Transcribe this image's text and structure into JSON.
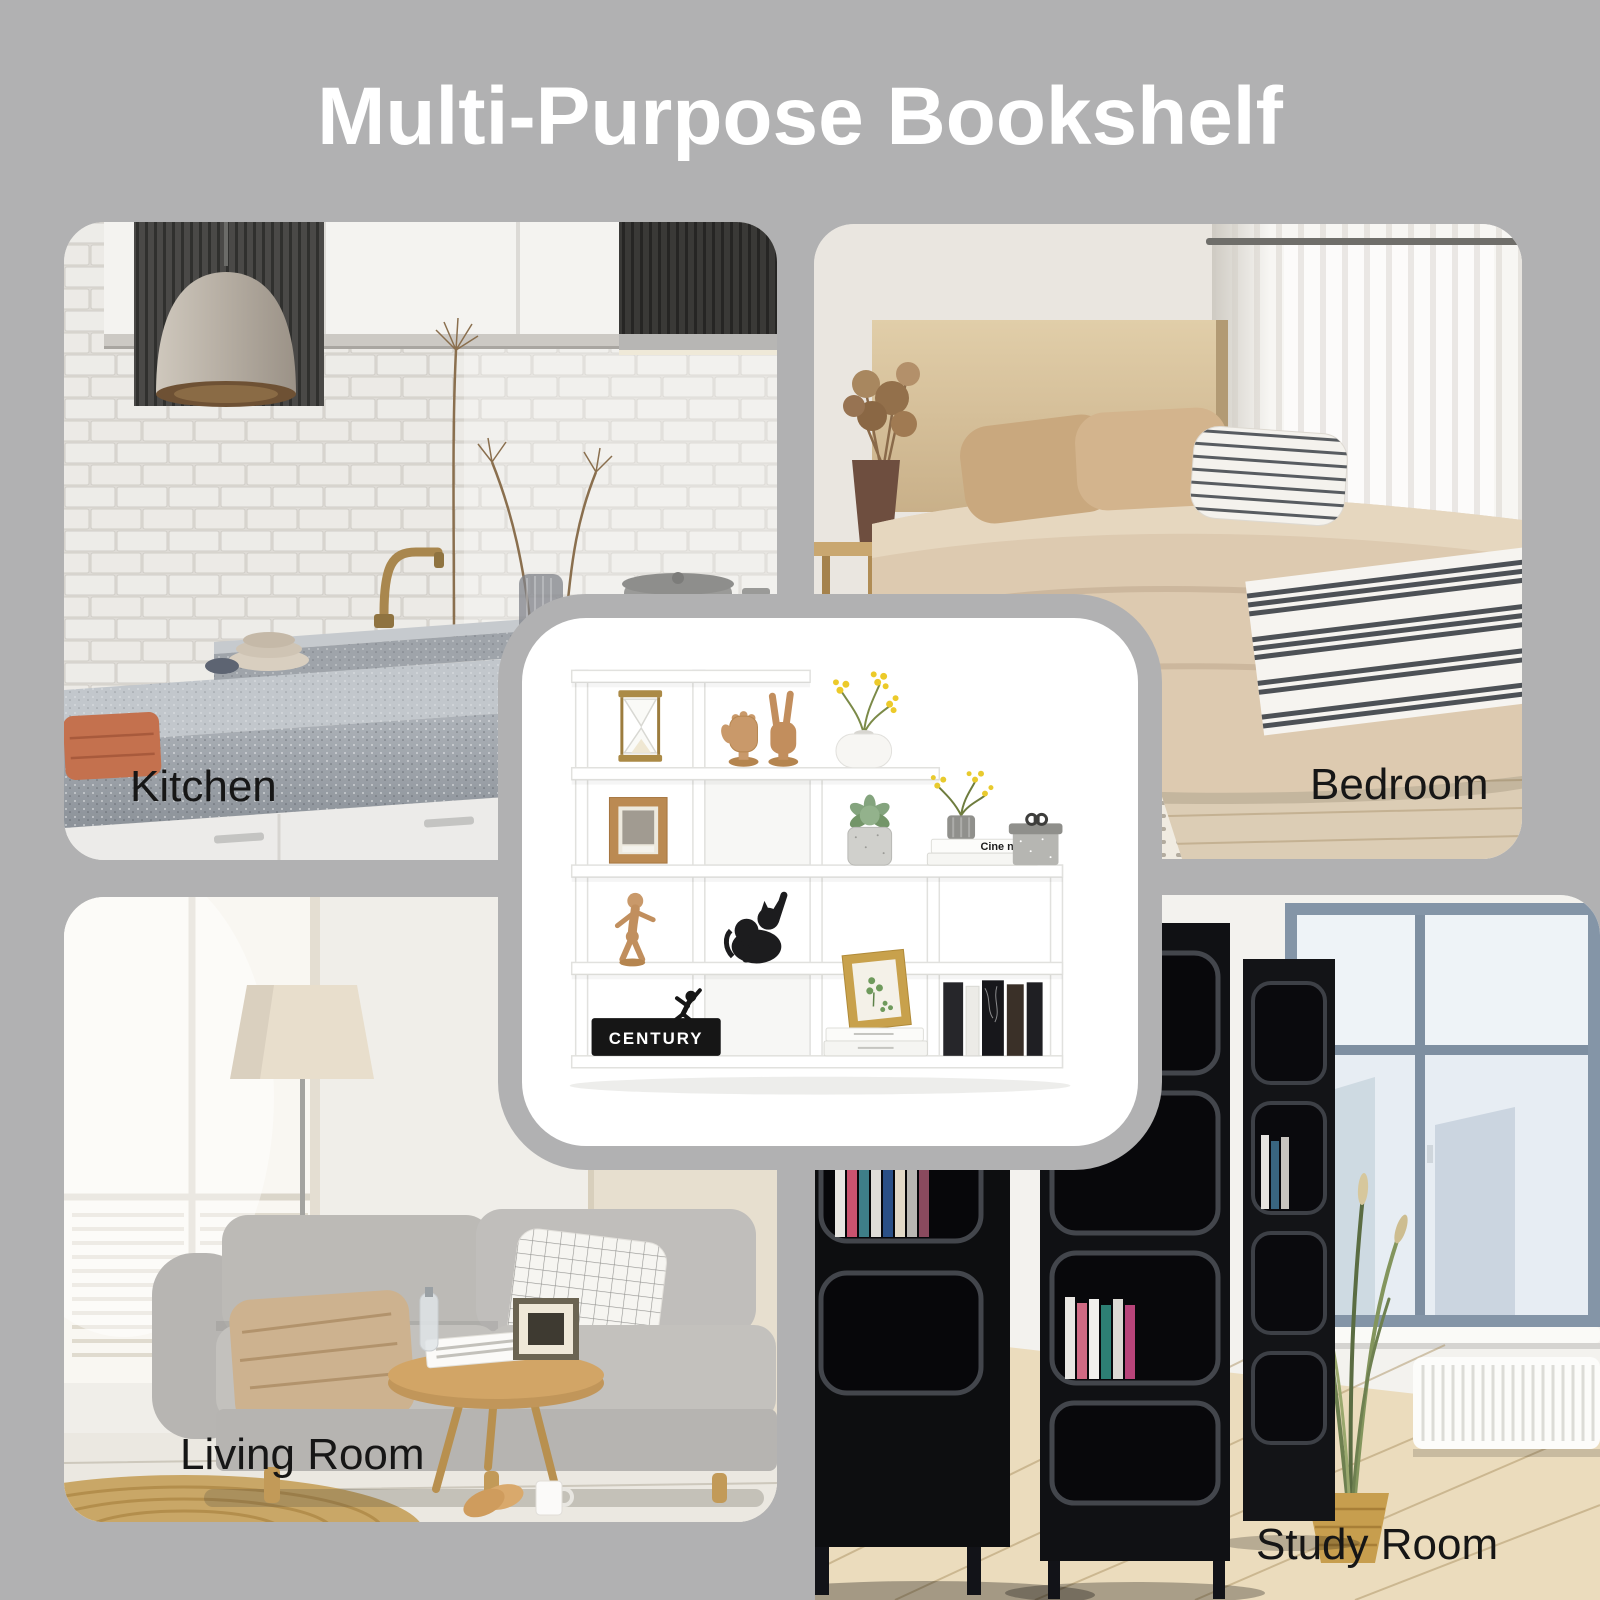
{
  "page": {
    "title": "Multi-Purpose Bookshelf",
    "title_color": "#ffffff",
    "background_color": "#b1b1b2",
    "label_color": "#161616"
  },
  "rooms": [
    {
      "label": "Kitchen",
      "position": "top-left"
    },
    {
      "label": "Bedroom",
      "position": "top-right"
    },
    {
      "label": "Living Room",
      "position": "bottom-left"
    },
    {
      "label": "Study Room",
      "position": "bottom-right"
    }
  ],
  "product_card": {
    "description": "White S-shaped 5-tier ladder display bookshelf decorated with hourglass, wooden hands, flowers, picture frames, succulent, mannequin, black cat figurine, books and gift box",
    "shelf_color": "#ffffff",
    "bookend_text": "CENTURY",
    "book_spine_text": "Cine noi ?"
  }
}
